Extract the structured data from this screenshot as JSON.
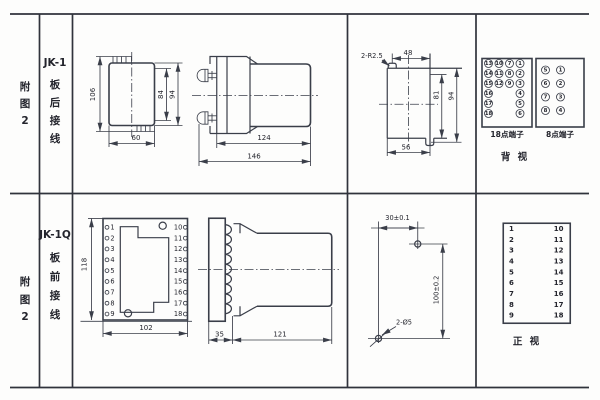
{
  "page": {
    "background": "#fdfdfc",
    "line_color": "#3a3e49",
    "text_color": "#23242c"
  },
  "rows": [
    {
      "figure_label": [
        "附",
        "图",
        "2"
      ],
      "model_label": [
        "JK-1",
        "板",
        "后",
        "接",
        "线"
      ],
      "rear_view": {
        "dims": {
          "height": "106",
          "inner_height": "84",
          "outer_height": "94",
          "width": "60"
        }
      },
      "side_view": {
        "dims": {
          "body_length": "124",
          "total_length": "146"
        }
      },
      "panel_cutout": {
        "dims": {
          "corner_radius": "2-R2.5",
          "top_width": "48",
          "inner_height": "81",
          "outer_height": "94",
          "bottom_width": "56"
        }
      },
      "terminals_back": {
        "block18": {
          "label": "18点端子",
          "rows": [
            [
              "13",
              "10",
              "7",
              "1"
            ],
            [
              "14",
              "11",
              "8",
              "2"
            ],
            [
              "15",
              "12",
              "9",
              "3"
            ],
            [
              "16",
              "",
              "",
              "4"
            ],
            [
              "17",
              "",
              "",
              "5"
            ],
            [
              "18",
              "",
              "",
              "6"
            ]
          ]
        },
        "block8": {
          "label": "8点端子",
          "rows": [
            [
              "5",
              "1"
            ],
            [
              "6",
              "2"
            ],
            [
              "7",
              "3"
            ],
            [
              "8",
              "4"
            ]
          ]
        },
        "view_label": "背 视"
      }
    },
    {
      "figure_label": [
        "附",
        "图",
        "2"
      ],
      "model_label": [
        "JK-1Q",
        "板",
        "前",
        "接",
        "线"
      ],
      "front_view": {
        "dims": {
          "height": "118",
          "width": "102"
        },
        "left_terminals": [
          "1",
          "2",
          "3",
          "4",
          "5",
          "6",
          "7",
          "8",
          "9"
        ],
        "right_terminals": [
          "10",
          "11",
          "12",
          "13",
          "14",
          "15",
          "16",
          "17",
          "18"
        ]
      },
      "side_view": {
        "dims": {
          "flange_depth": "35",
          "body_length": "121"
        }
      },
      "drill_template": {
        "dims": {
          "horizontal": "30±0.1",
          "vertical": "100±0.2",
          "holes": "2-Ø5"
        }
      },
      "terminals_front": {
        "left": [
          "1",
          "2",
          "3",
          "4",
          "5",
          "6",
          "7",
          "8",
          "9"
        ],
        "right": [
          "10",
          "11",
          "12",
          "13",
          "14",
          "15",
          "16",
          "17",
          "18"
        ],
        "view_label": "正 视"
      }
    }
  ]
}
